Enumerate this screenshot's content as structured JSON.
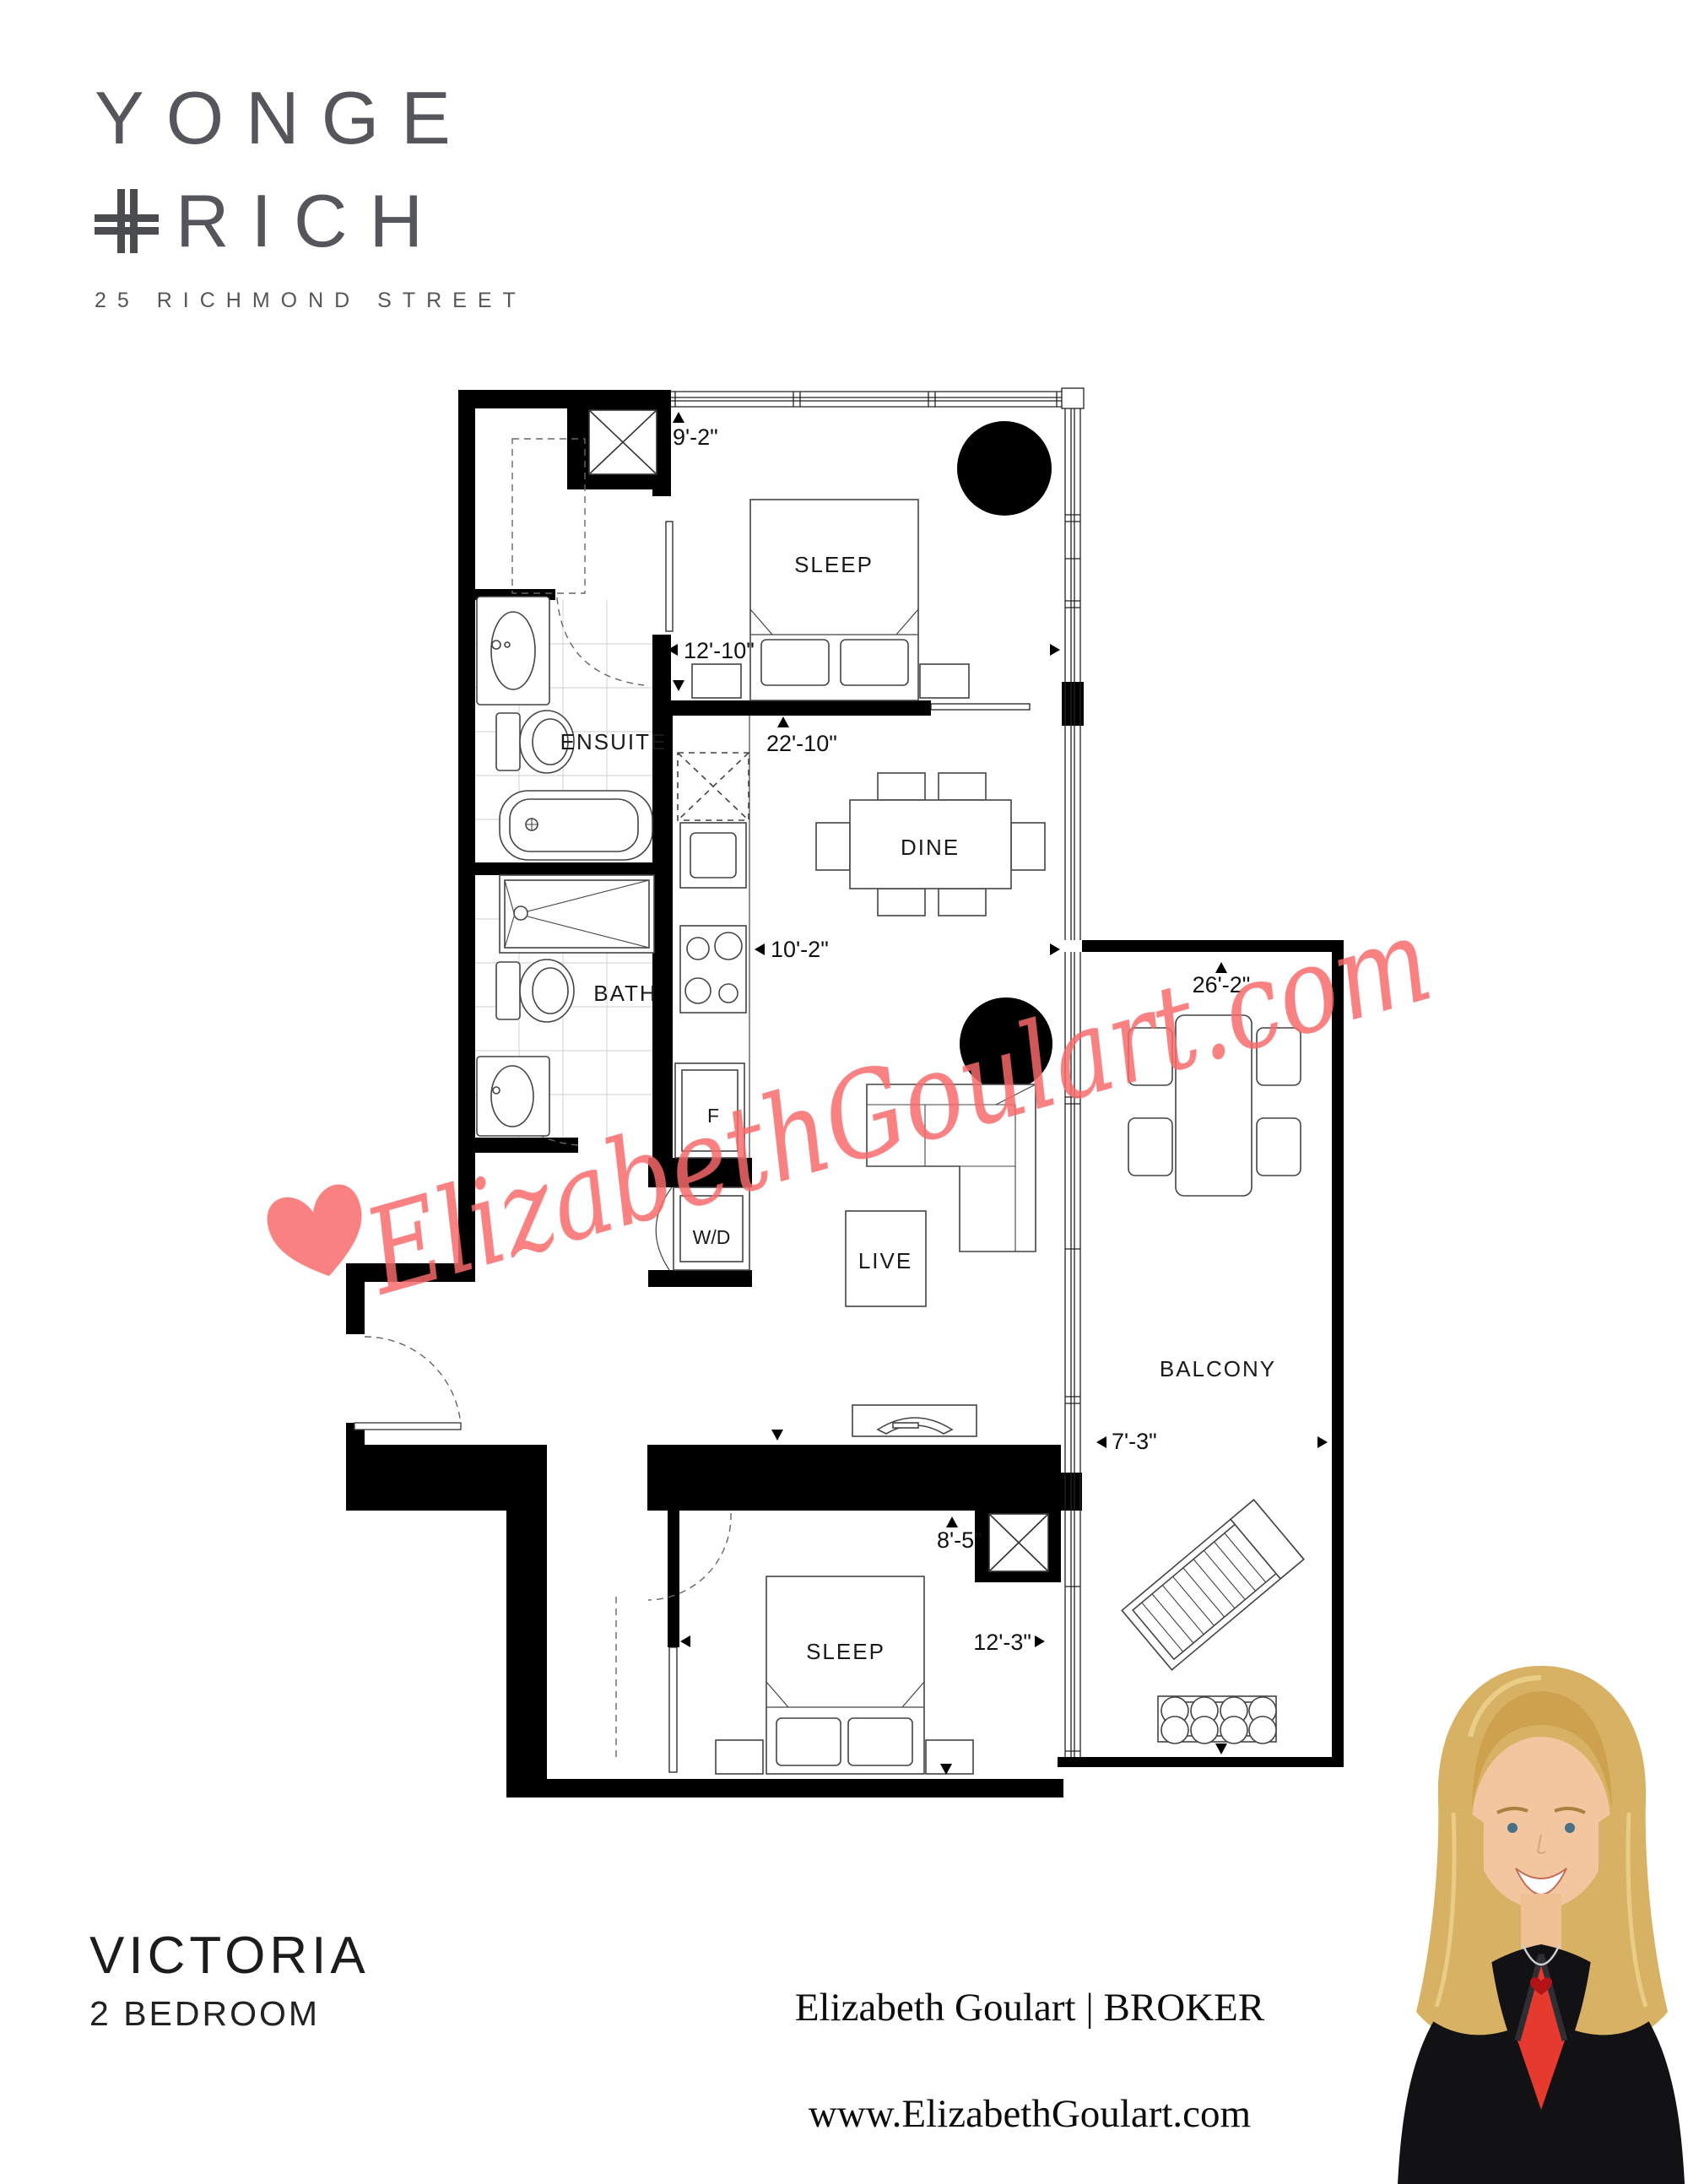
{
  "brand": {
    "name_line1": "YONGE",
    "plus_symbol": "+",
    "name_line2": "RICH",
    "address": "25 RICHMOND STREET",
    "color": "#54565b"
  },
  "unit": {
    "name": "VICTORIA",
    "type": "2 BEDROOM"
  },
  "watermark": {
    "text": "ElizabethGoulart.com",
    "color": "#f8696a"
  },
  "footer": {
    "broker_name": "Elizabeth Goulart",
    "divider": "|",
    "broker_title": "BROKER",
    "broker_line": "Elizabeth Goulart | BROKER",
    "website": "www.ElizabethGoulart.com"
  },
  "plan": {
    "rooms": {
      "sleep1": "SLEEP",
      "ensuite": "ENSUITE",
      "bath": "BATH",
      "dine": "DINE",
      "live": "LIVE",
      "balcony": "BALCONY",
      "sleep2": "SLEEP",
      "washer_dryer": "W/D",
      "fridge": "F"
    },
    "dimensions": {
      "bed1_depth": "9'-2\"",
      "bed1_width": "12'-10\"",
      "main_length": "22'-10\"",
      "main_width": "10'-2\"",
      "balcony_length": "26'-2\"",
      "balcony_width": "7'-3\"",
      "bed2_depth": "8'-5\"",
      "bed2_width": "12'-3\""
    }
  }
}
